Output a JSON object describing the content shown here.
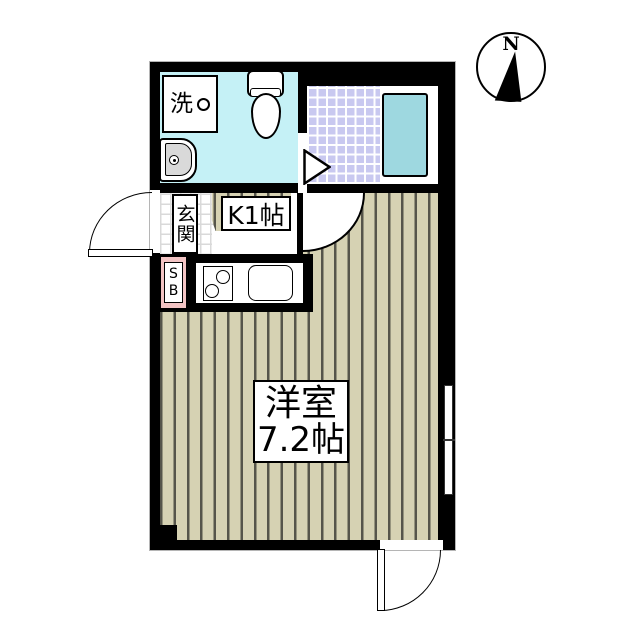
{
  "plan": {
    "compass": {
      "north": "N"
    },
    "washroom": {
      "washer": "洗"
    },
    "entrance": {
      "label": "玄関"
    },
    "kitchen": {
      "label": "K1帖"
    },
    "shoebox": {
      "s": "S",
      "b": "B"
    },
    "room": {
      "name": "洋室",
      "size": "7.2帖"
    },
    "colors": {
      "wall": "#000000",
      "washroom_floor": "#c5f1f6",
      "bath_tile": "#c9c9f0",
      "bathtub": "#9ed8e0",
      "wood_floor": "#d6d2b3",
      "floor_stripe": "#56554a",
      "shoebox_pink": "#f3c4c4",
      "sink_bowl": "#d9d9d9"
    }
  }
}
